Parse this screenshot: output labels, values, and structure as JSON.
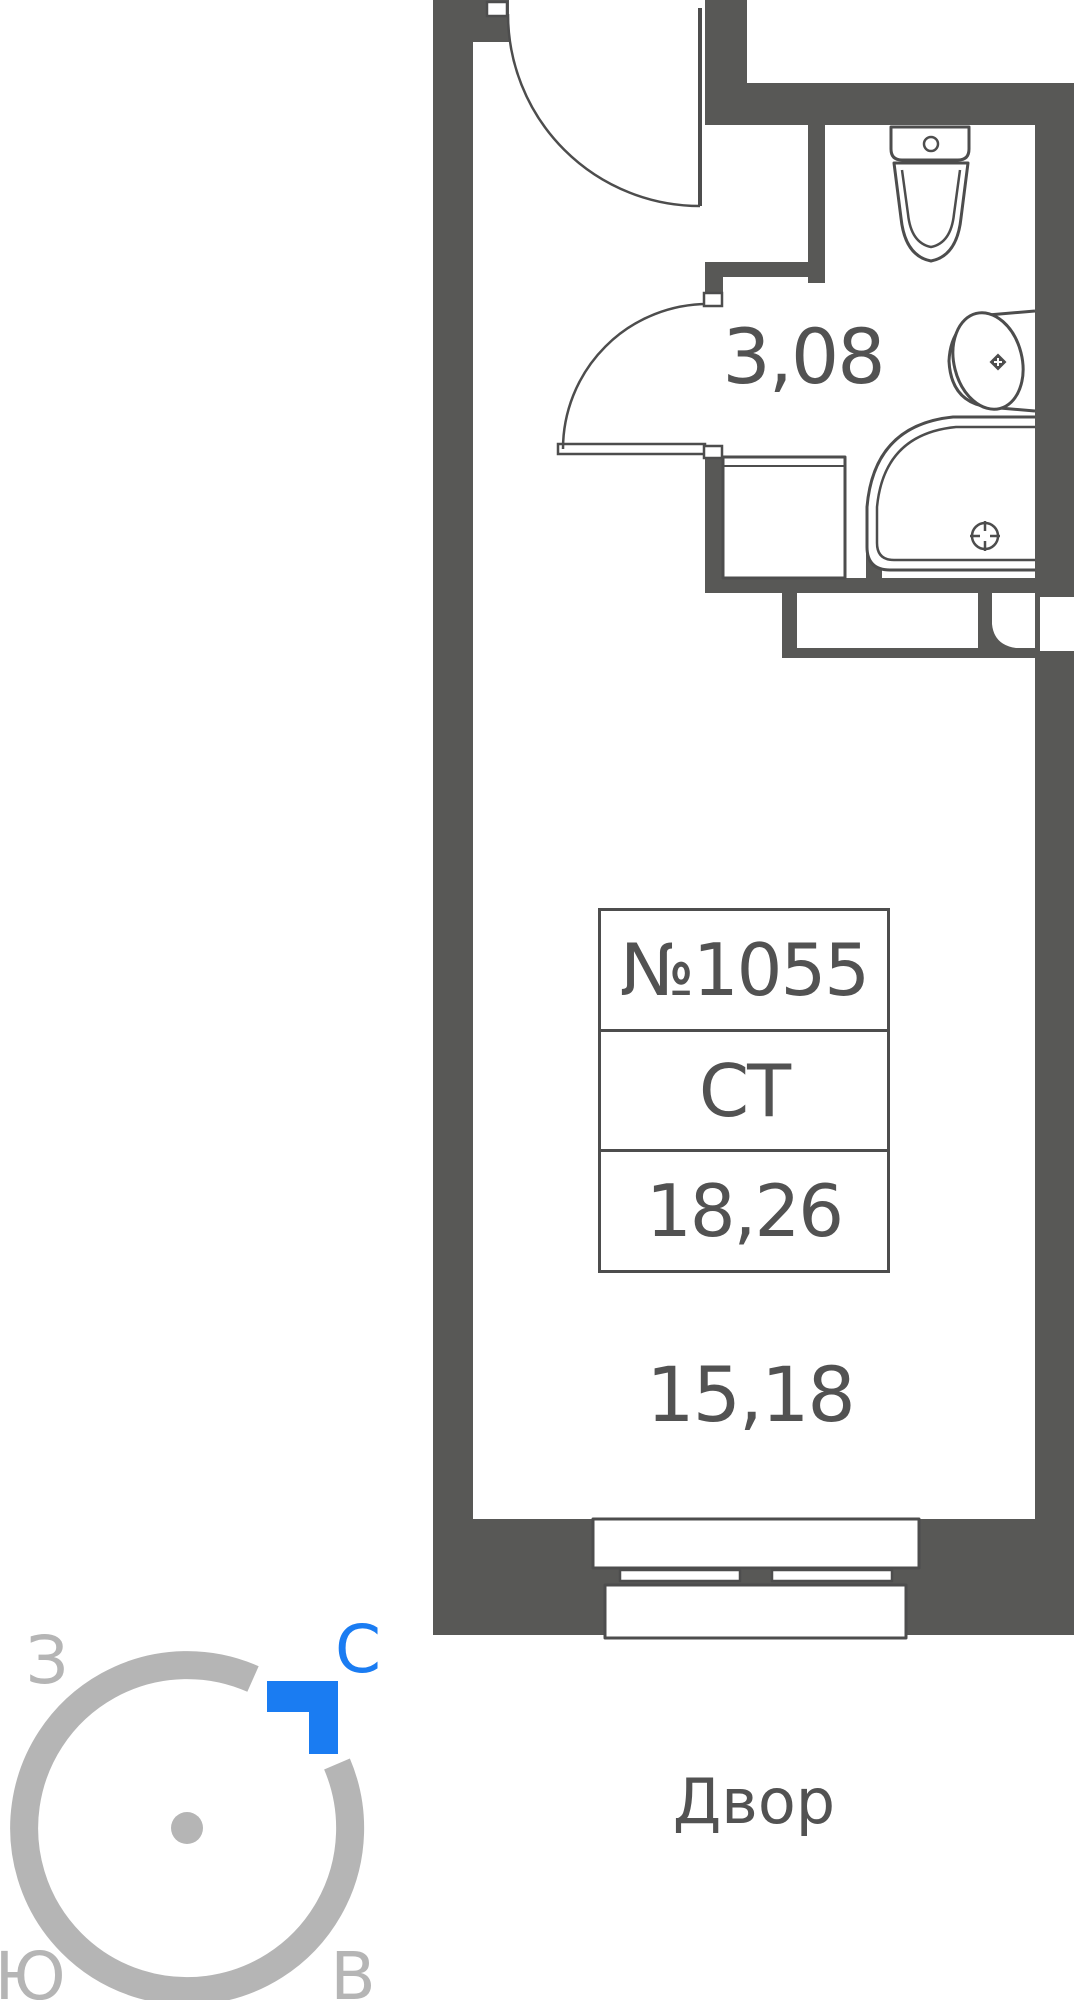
{
  "unit_card": {
    "number": "№1055",
    "type_label": "СТ",
    "total_area": "18,26"
  },
  "area_labels": {
    "bathroom": "3,08",
    "main_room": "15,18"
  },
  "outside_label": "Двор",
  "compass": {
    "north": "С",
    "south": "Ю",
    "west": "З",
    "east": "В"
  },
  "colors": {
    "wall": "#585856",
    "line": "#4d4d4d",
    "text": "#525252",
    "compass": "#b5b5b5",
    "north": "#1a7cf2"
  }
}
